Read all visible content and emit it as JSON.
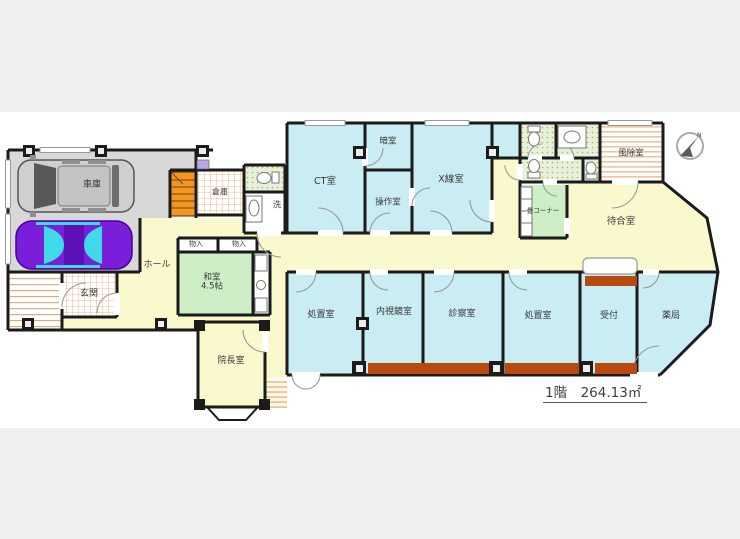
{
  "floor_summary": {
    "label": "1階　264.13㎡"
  },
  "compass": {
    "label": "N"
  },
  "rooms": {
    "garage": "車庫",
    "storage": "倉庫",
    "laundry": "洗",
    "hall": "ホール",
    "closet_1": "物入",
    "closet_2": "物入",
    "japanese_room": {
      "name": "和室",
      "size": "4.5帖"
    },
    "entrance": "玄関",
    "directors_office": "院長室",
    "ct_room": "CT室",
    "dark_room": "暗室",
    "control_room": "操作室",
    "xray_room": "X線室",
    "windbreak_room": "風除室",
    "tatami_corner": "畳コーナー",
    "waiting_room": "待合室",
    "treatment_room_1": "処置室",
    "endoscopy_room": "内視鏡室",
    "exam_room": "診察室",
    "treatment_room_2": "処置室",
    "reception": "受付",
    "pharmacy": "薬局"
  },
  "colors": {
    "wall": "#1b1b1b",
    "room_blue": "#c9edf2",
    "room_yellow": "#faf8cd",
    "room_green": "#cdeec6",
    "stairs_orange": "#f6951d",
    "window_band_brown": "#b8490f",
    "garage_floor": "#d8d8d8",
    "letterbox_gray": "#f0f0f0",
    "sports_car_purple": "#7a1fd9",
    "glass_cyan": "#3fd9ea"
  }
}
